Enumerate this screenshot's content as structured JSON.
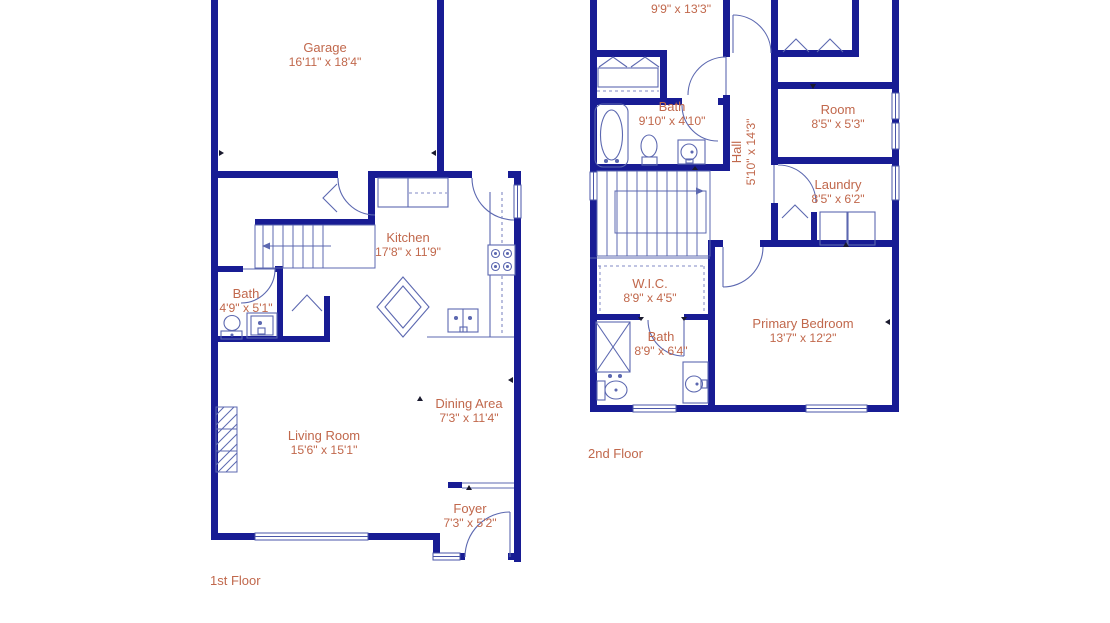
{
  "title": "Two-story floor plan",
  "colors": {
    "wall": "#181C94",
    "fixture_line": "#5C68B0",
    "window_line": "#4A56A8",
    "label_text": "#C1684C",
    "background": "#FFFFFF"
  },
  "floors": [
    {
      "label": "1st Floor",
      "rooms": [
        {
          "id": "garage",
          "name": "Garage",
          "dims": "16'11\" x 18'4\""
        },
        {
          "id": "kitchen",
          "name": "Kitchen",
          "dims": "17'8\" x 11'9\""
        },
        {
          "id": "bath",
          "name": "Bath",
          "dims": "4'9\" x 5'1\""
        },
        {
          "id": "living-room",
          "name": "Living Room",
          "dims": "15'6\" x 15'1\""
        },
        {
          "id": "dining-area",
          "name": "Dining Area",
          "dims": "7'3\" x 11'4\""
        },
        {
          "id": "foyer",
          "name": "Foyer",
          "dims": "7'3\" x 5'2\""
        }
      ]
    },
    {
      "label": "2nd Floor",
      "rooms": [
        {
          "id": "bedroom-top",
          "name": "",
          "dims": "9'9\" x 13'3\""
        },
        {
          "id": "bath-hall",
          "name": "Bath",
          "dims": "9'10\" x 4'10\""
        },
        {
          "id": "hall",
          "name": "Hall",
          "dims": "5'10\" x 14'3\""
        },
        {
          "id": "room",
          "name": "Room",
          "dims": "8'5\" x 5'3\""
        },
        {
          "id": "laundry",
          "name": "Laundry",
          "dims": "8'5\" x 6'2\""
        },
        {
          "id": "wic",
          "name": "W.I.C.",
          "dims": "8'9\" x 4'5\""
        },
        {
          "id": "bath-primary",
          "name": "Bath",
          "dims": "8'9\" x 6'4\""
        },
        {
          "id": "primary-bedroom",
          "name": "Primary Bedroom",
          "dims": "13'7\" x 12'2\""
        }
      ]
    }
  ]
}
